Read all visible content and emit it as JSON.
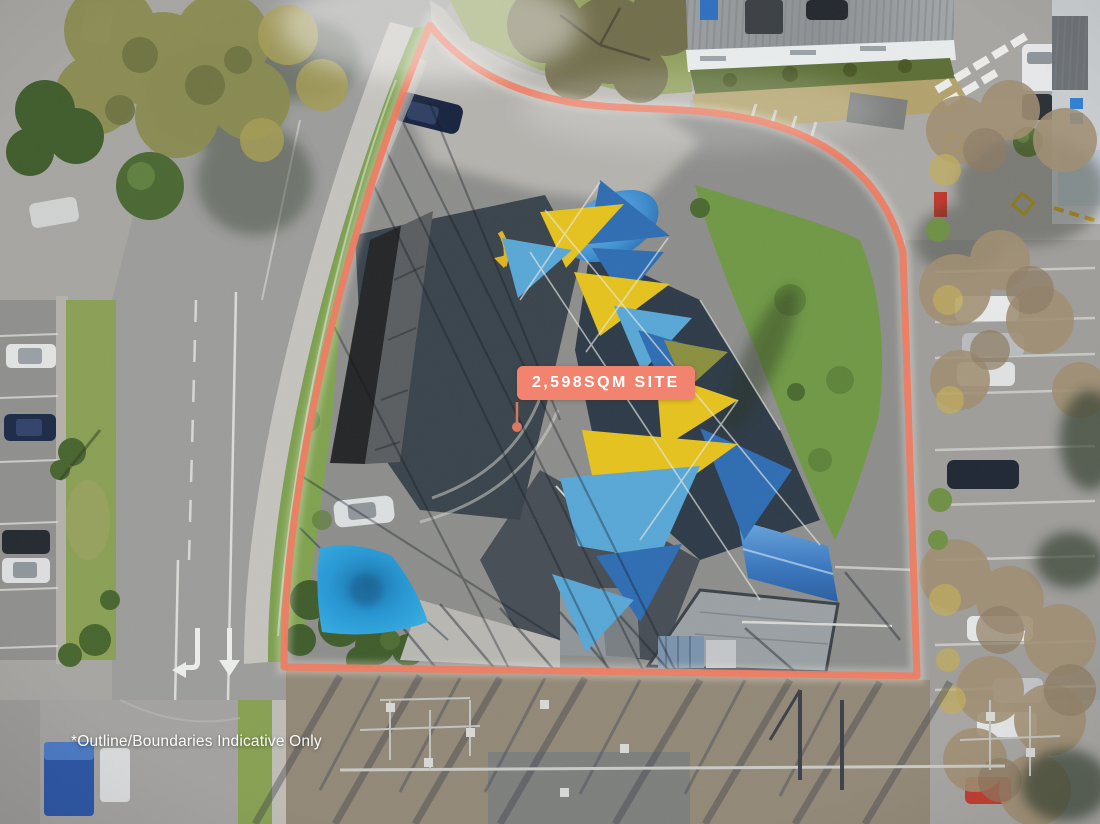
{
  "annotations": {
    "site_label": "2,598SQM SITE",
    "disclaimer": "*Outline/Boundaries Indicative Only"
  },
  "colors": {
    "boundary": "#EE7B61",
    "label_bg": "#F2836E",
    "label_text": "#FFFFFF",
    "sail_yellow": "#E5C21D",
    "sail_blue": "#2E6CB2",
    "sail_light_blue": "#58A7D6",
    "square_sail_blue": "#2AA0DC",
    "tarp_blue": "#3E8ED0"
  }
}
